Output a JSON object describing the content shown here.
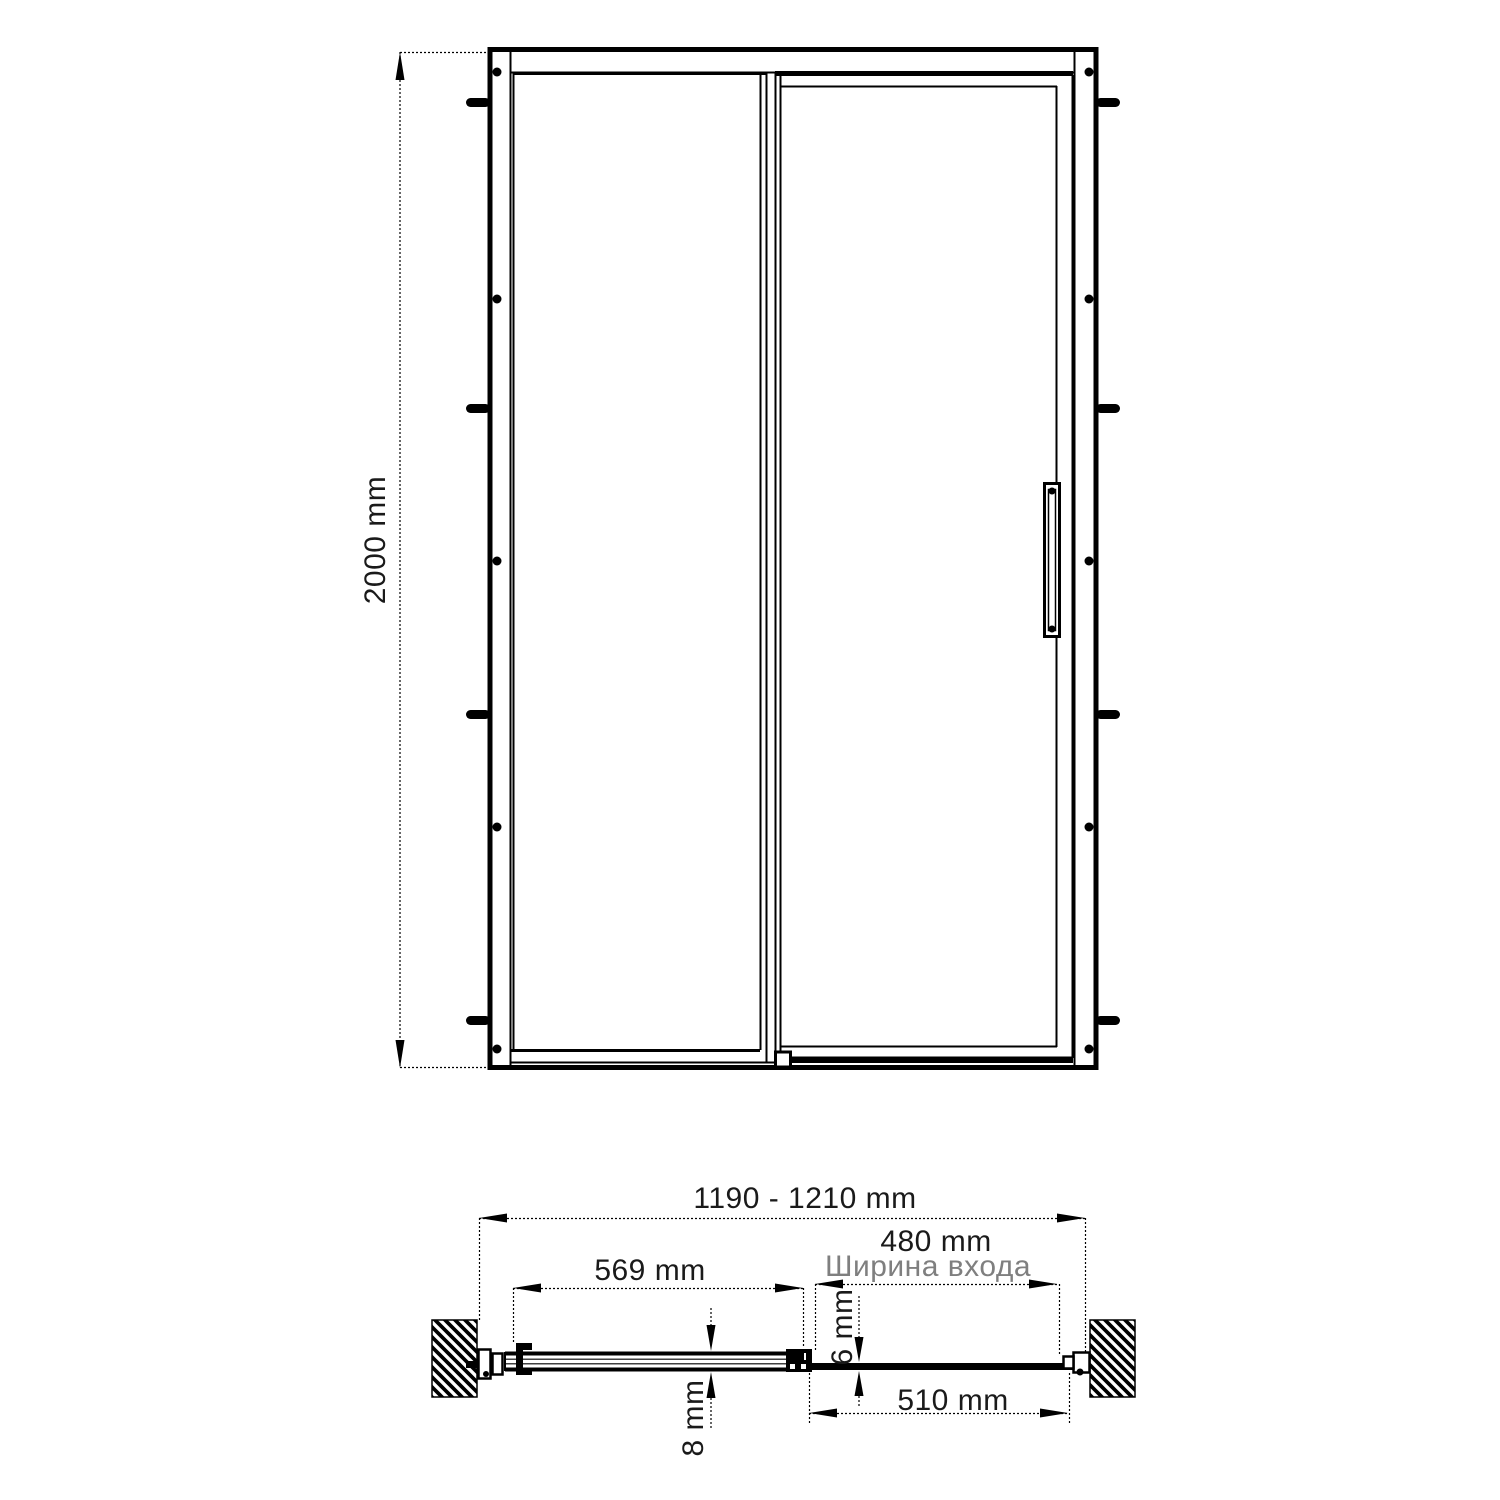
{
  "drawing": {
    "subject": "sliding shower door technical drawing",
    "views": 2
  },
  "dimensions": {
    "height": "2000 mm",
    "overall_width": "1190 - 1210 mm",
    "fixed_panel_width": "569 mm",
    "entry_width": "480 mm",
    "entry_width_caption": "Ширина входа",
    "door_panel_width": "510 mm",
    "fixed_glass_thickness": "8 mm",
    "door_glass_thickness": "6 mm"
  },
  "colors": {
    "line": "#000000",
    "dimension_text": "#1a1a1a",
    "muted_label": "#7f7f7f",
    "background": "#ffffff"
  }
}
